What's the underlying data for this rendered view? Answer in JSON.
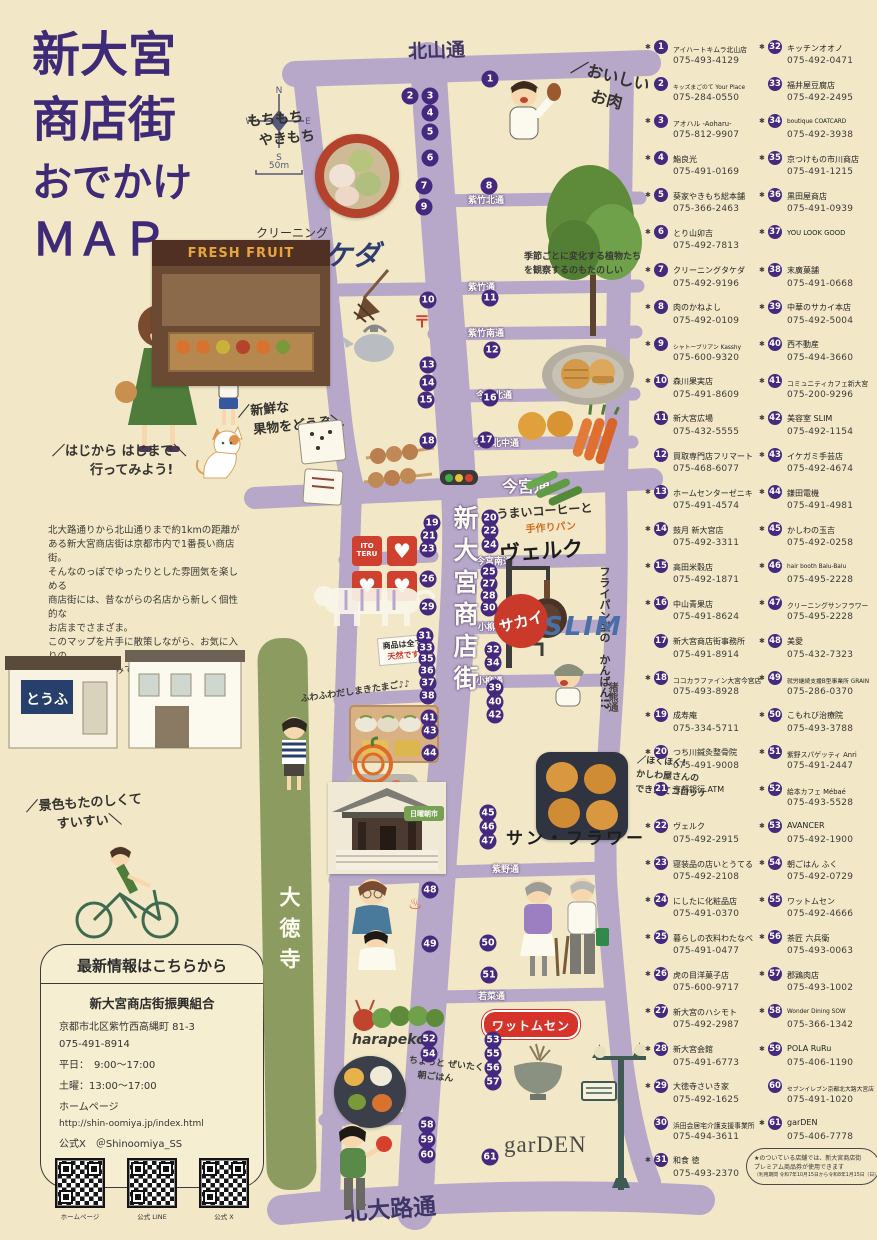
{
  "colors": {
    "bg": "#f2e8c7",
    "road": "#b7a8c9",
    "marker_purple": "#45297e",
    "title_purple": "#3e2a76",
    "red": "#cf3b2a",
    "green_strip": "#8c9c60",
    "street_dark": "#3f3566"
  },
  "title": {
    "lines": [
      "新大宮",
      "商店街",
      "おでかけ",
      "ＭＡＰ"
    ]
  },
  "intro": "北大路通りから北山通りまで約1kmの距離が\nある新大宮商店街は京都市内で1番長い商店街。\nそんなのっぽでゆったりとした雰囲気を楽しめる\n商店街には、昔ながらの名店から新しく個性的な\nお店までさまざま。\nこのマップを片手に散策しながら、お気に入りの\nお店を見つけてみてください♩",
  "compass": {
    "n": "N",
    "e": "E",
    "s": "S",
    "w": "W",
    "scale": "50m"
  },
  "streets": {
    "kitayama": "北山通",
    "shichiku_kita": "紫竹北通",
    "shichiku": "紫竹通",
    "shichiku_minami": "紫竹南通",
    "imamiya_kita": "今宮北通",
    "imamiya_kitanaka": "今宮北中通",
    "imamiya": "今宮通",
    "imamiya_minami": "今宮南通",
    "koyanagi_kita": "小柳北通",
    "koyanagi": "小柳通",
    "inokuma": "猪熊通",
    "murasakino": "紫野通",
    "wakana": "若菜通",
    "kitaoji": "北大路通",
    "daitokuji": "大徳寺",
    "shotengai": "新大宮商店街"
  },
  "callouts": {
    "mochi1": "もちもち",
    "mochi2": "やきもち",
    "takeda_small": "クリーニング",
    "takeda_big": "タケダ",
    "oniku1": "おいしい",
    "oniku2": "お肉",
    "seasonal": "季節ごとに変化する植物たちを観察するのもたのしい",
    "fresh1": "新鮮な",
    "fresh2": "果物をどうぞ",
    "walk1": "はじから はじまで",
    "walk2": "行ってみよう!",
    "verk1": "うまいコーヒーと",
    "verk2": "手作りパン",
    "verk_name": "ヴェルク",
    "frypan1": "フライパン型の",
    "frypan2": "かんばん!?",
    "tennen1": "商品は全て",
    "tennen2": "天然です",
    "dashimaki": "ふわふわだしまきたまご♪♪",
    "croq1": "ほくほく!",
    "croq2": "かしわ屋さんの",
    "croq3": "できたてコロッケ",
    "sunflower": "サン・フラワー",
    "scenery1": "景色もたのしくて",
    "scenery2": "すいすい",
    "breakfast1": "ちょっと ぜいたくな",
    "breakfast2": "朝ごはん",
    "harapeko": "harapeko",
    "wattomsen": "ワットムセン",
    "garden": "garDEN",
    "sakai": "サカイ",
    "slim": "SLIM",
    "itoteru": "ITO TERU",
    "freshfruit": "FRESH FRUIT",
    "tofu": "とうふ",
    "temple_badge": "日曜朝市",
    "post_mark": "〒",
    "onsen_mark": "♨"
  },
  "info_box": {
    "title": "最新情報はこちらから",
    "org": "新大宮商店街振興組合",
    "address": "京都市北区紫竹西高縄町 81-3",
    "phone": "075-491-8914",
    "weekday": "平日：　9:00～17:00",
    "saturday": "土曜：13:00～17:00",
    "hp_label": "ホームページ",
    "url": "http://shin-oomiya.jp/index.html",
    "official_x": "公式X　＠Shinoomiya_SS",
    "qr_labels": [
      "ホームページ",
      "公式 LINE",
      "公式 X"
    ]
  },
  "map": {
    "markers": [
      {
        "n": 1,
        "x": 490,
        "y": 79
      },
      {
        "n": 2,
        "x": 410,
        "y": 96
      },
      {
        "n": 3,
        "x": 430,
        "y": 96
      },
      {
        "n": 4,
        "x": 430,
        "y": 113
      },
      {
        "n": 5,
        "x": 430,
        "y": 132
      },
      {
        "n": 6,
        "x": 430,
        "y": 158
      },
      {
        "n": 7,
        "x": 424,
        "y": 186
      },
      {
        "n": 8,
        "x": 489,
        "y": 186
      },
      {
        "n": 9,
        "x": 424,
        "y": 207
      },
      {
        "n": 10,
        "x": 428,
        "y": 300
      },
      {
        "n": 11,
        "x": 490,
        "y": 298
      },
      {
        "n": 12,
        "x": 492,
        "y": 350
      },
      {
        "n": 13,
        "x": 428,
        "y": 365
      },
      {
        "n": 14,
        "x": 428,
        "y": 383
      },
      {
        "n": 15,
        "x": 426,
        "y": 400
      },
      {
        "n": 16,
        "x": 490,
        "y": 398
      },
      {
        "n": 17,
        "x": 486,
        "y": 440
      },
      {
        "n": 18,
        "x": 428,
        "y": 441
      },
      {
        "n": 19,
        "x": 432,
        "y": 523
      },
      {
        "n": 20,
        "x": 490,
        "y": 518
      },
      {
        "n": 21,
        "x": 429,
        "y": 536
      },
      {
        "n": 22,
        "x": 490,
        "y": 531
      },
      {
        "n": 23,
        "x": 428,
        "y": 549
      },
      {
        "n": 24,
        "x": 490,
        "y": 545
      },
      {
        "n": 25,
        "x": 489,
        "y": 572
      },
      {
        "n": 26,
        "x": 428,
        "y": 579
      },
      {
        "n": 27,
        "x": 489,
        "y": 584
      },
      {
        "n": 28,
        "x": 489,
        "y": 596
      },
      {
        "n": 29,
        "x": 428,
        "y": 607
      },
      {
        "n": 30,
        "x": 489,
        "y": 608
      },
      {
        "n": 31,
        "x": 425,
        "y": 636
      },
      {
        "n": 32,
        "x": 493,
        "y": 650
      },
      {
        "n": 33,
        "x": 426,
        "y": 648
      },
      {
        "n": 34,
        "x": 493,
        "y": 663
      },
      {
        "n": 35,
        "x": 427,
        "y": 659
      },
      {
        "n": 36,
        "x": 427,
        "y": 671
      },
      {
        "n": 37,
        "x": 428,
        "y": 683
      },
      {
        "n": 38,
        "x": 428,
        "y": 696
      },
      {
        "n": 39,
        "x": 495,
        "y": 688
      },
      {
        "n": 40,
        "x": 495,
        "y": 702
      },
      {
        "n": 41,
        "x": 429,
        "y": 718
      },
      {
        "n": 42,
        "x": 495,
        "y": 715
      },
      {
        "n": 43,
        "x": 430,
        "y": 731
      },
      {
        "n": 44,
        "x": 430,
        "y": 753
      },
      {
        "n": 45,
        "x": 488,
        "y": 813
      },
      {
        "n": 46,
        "x": 488,
        "y": 827
      },
      {
        "n": 47,
        "x": 488,
        "y": 841
      },
      {
        "n": 48,
        "x": 430,
        "y": 890
      },
      {
        "n": 49,
        "x": 430,
        "y": 944
      },
      {
        "n": 50,
        "x": 488,
        "y": 943
      },
      {
        "n": 51,
        "x": 489,
        "y": 975
      },
      {
        "n": 52,
        "x": 429,
        "y": 1039
      },
      {
        "n": 53,
        "x": 493,
        "y": 1040
      },
      {
        "n": 54,
        "x": 429,
        "y": 1054
      },
      {
        "n": 55,
        "x": 493,
        "y": 1054
      },
      {
        "n": 56,
        "x": 493,
        "y": 1068
      },
      {
        "n": 57,
        "x": 493,
        "y": 1082
      },
      {
        "n": 58,
        "x": 427,
        "y": 1125
      },
      {
        "n": 59,
        "x": 427,
        "y": 1140
      },
      {
        "n": 60,
        "x": 427,
        "y": 1155
      },
      {
        "n": 61,
        "x": 490,
        "y": 1157
      }
    ]
  },
  "directory": {
    "col1": [
      {
        "n": 1,
        "name": "アイハートキムラ北山店",
        "phone": "075-493-4129",
        "star": true
      },
      {
        "n": 2,
        "name": "キッズまごのて Your Place",
        "phone": "075-284-0550",
        "star": false
      },
      {
        "n": 3,
        "name": "アオハル -Aoharu-",
        "phone": "075-812-9907",
        "star": true
      },
      {
        "n": 4,
        "name": "鮨良光",
        "phone": "075-491-0169",
        "star": true
      },
      {
        "n": 5,
        "name": "葵家やきもち総本舗",
        "phone": "075-366-2463",
        "star": true
      },
      {
        "n": 6,
        "name": "とり山卯吉",
        "phone": "075-492-7813",
        "star": true
      },
      {
        "n": 7,
        "name": "クリーニングタケダ",
        "phone": "075-492-9196",
        "star": true
      },
      {
        "n": 8,
        "name": "肉のかねよし",
        "phone": "075-492-0109",
        "star": true
      },
      {
        "n": 9,
        "name": "シャトーブリアン Kasshy",
        "phone": "075-600-9320",
        "star": true
      },
      {
        "n": 10,
        "name": "森川果実店",
        "phone": "075-491-8609",
        "star": true
      },
      {
        "n": 11,
        "name": "新大宮広場",
        "phone": "075-432-5555",
        "star": false
      },
      {
        "n": 12,
        "name": "買取専門店フリマート",
        "phone": "075-468-6077",
        "star": false
      },
      {
        "n": 13,
        "name": "ホームセンターゼニキ",
        "phone": "075-491-4574",
        "star": true
      },
      {
        "n": 14,
        "name": "鼓月 新大宮店",
        "phone": "075-492-3311",
        "star": true
      },
      {
        "n": 15,
        "name": "高田米穀店",
        "phone": "075-492-1871",
        "star": true
      },
      {
        "n": 16,
        "name": "中山青果店",
        "phone": "075-491-8624",
        "star": true
      },
      {
        "n": 17,
        "name": "新大宮商店街事務所",
        "phone": "075-491-8914",
        "star": false
      },
      {
        "n": 18,
        "name": "ココカラファイン大宮今宮店",
        "phone": "075-493-8928",
        "star": true
      },
      {
        "n": 19,
        "name": "成寿庵",
        "phone": "075-334-5711",
        "star": true
      },
      {
        "n": 20,
        "name": "つち川鍼灸整骨院",
        "phone": "075-491-9008",
        "star": true
      },
      {
        "n": 21,
        "name": "京都銀行 ATM",
        "phone": "",
        "star": false
      },
      {
        "n": 22,
        "name": "ヴェルク",
        "phone": "075-492-2915",
        "star": true
      },
      {
        "n": 23,
        "name": "寝装品の店いとうてる",
        "phone": "075-492-2108",
        "star": true
      },
      {
        "n": 24,
        "name": "にしたに化粧品店",
        "phone": "075-491-0370",
        "star": true
      },
      {
        "n": 25,
        "name": "暮らしの衣料わたなべ",
        "phone": "075-491-0477",
        "star": true
      },
      {
        "n": 26,
        "name": "虎の目洋菓子店",
        "phone": "075-600-9717",
        "star": true
      },
      {
        "n": 27,
        "name": "新大宮のハシモト",
        "phone": "075-492-2987",
        "star": true
      },
      {
        "n": 28,
        "name": "新大宮会館",
        "phone": "075-491-6773",
        "star": true
      },
      {
        "n": 29,
        "name": "大徳寺さいき家",
        "phone": "075-492-1625",
        "star": true
      },
      {
        "n": 30,
        "name": "浜田会居宅介護支援事業所",
        "phone": "075-494-3611",
        "star": false
      },
      {
        "n": 31,
        "name": "和食 徳",
        "phone": "075-493-2370",
        "star": true
      }
    ],
    "col2": [
      {
        "n": 32,
        "name": "キッチンオオノ",
        "phone": "075-492-0471",
        "star": true
      },
      {
        "n": 33,
        "name": "福井屋豆腐店",
        "phone": "075-492-2495",
        "star": false
      },
      {
        "n": 34,
        "name": "boutique COATCARD",
        "phone": "075-492-3938",
        "star": true
      },
      {
        "n": 35,
        "name": "京つけもの市川商店",
        "phone": "075-491-1215",
        "star": true
      },
      {
        "n": 36,
        "name": "黒田屋商店",
        "phone": "075-491-0939",
        "star": true
      },
      {
        "n": 37,
        "name": "YOU LOOK GOOD",
        "phone": "",
        "star": true
      },
      {
        "n": 38,
        "name": "末廣菓舗",
        "phone": "075-491-0668",
        "star": true
      },
      {
        "n": 39,
        "name": "中華のサカイ本店",
        "phone": "075-492-5004",
        "star": true
      },
      {
        "n": 40,
        "name": "西不動産",
        "phone": "075-494-3660",
        "star": true
      },
      {
        "n": 41,
        "name": "コミュニティカフェ新大宮",
        "phone": "075-200-9296",
        "star": true
      },
      {
        "n": 42,
        "name": "美容室 SLIM",
        "phone": "075-492-1154",
        "star": true
      },
      {
        "n": 43,
        "name": "イケガミ手芸店",
        "phone": "075-492-4674",
        "star": true
      },
      {
        "n": 44,
        "name": "鎌田電機",
        "phone": "075-491-4981",
        "star": true
      },
      {
        "n": 45,
        "name": "かしわの玉吉",
        "phone": "075-492-0258",
        "star": true
      },
      {
        "n": 46,
        "name": "hair booth Balu-Balu",
        "phone": "075-495-2228",
        "star": true
      },
      {
        "n": 47,
        "name": "クリーニングサンフラワー",
        "phone": "075-495-2228",
        "star": true
      },
      {
        "n": 48,
        "name": "美愛",
        "phone": "075-432-7323",
        "star": true
      },
      {
        "n": 49,
        "name": "就労継続支援B型事業所 GRAIN",
        "phone": "075-286-0370",
        "star": true
      },
      {
        "n": 50,
        "name": "こもれび治療院",
        "phone": "075-493-3788",
        "star": true
      },
      {
        "n": 51,
        "name": "紫野スパゲッティ Anri",
        "phone": "075-491-2447",
        "star": true
      },
      {
        "n": 52,
        "name": "絵本カフェ Mébaé",
        "phone": "075-493-5528",
        "star": true
      },
      {
        "n": 53,
        "name": "AVANCER",
        "phone": "075-492-1900",
        "star": true
      },
      {
        "n": 54,
        "name": "朝ごはん ふく",
        "phone": "075-492-0729",
        "star": true
      },
      {
        "n": 55,
        "name": "ワットムセン",
        "phone": "075-492-4666",
        "star": true
      },
      {
        "n": 56,
        "name": "茶匠 六兵衛",
        "phone": "075-493-0063",
        "star": true
      },
      {
        "n": 57,
        "name": "郡鶏肉店",
        "phone": "075-493-1002",
        "star": true
      },
      {
        "n": 58,
        "name": "Wonder Dining SOW",
        "phone": "075-366-1342",
        "star": true
      },
      {
        "n": 59,
        "name": "POLA RuRu",
        "phone": "075-406-1190",
        "star": true
      },
      {
        "n": 60,
        "name": "セブンイレブン京都北大路大宮店",
        "phone": "075-491-1020",
        "star": false
      },
      {
        "n": 61,
        "name": "garDEN",
        "phone": "075-406-7778",
        "star": true
      }
    ],
    "note": [
      "★のついている店舗では、新大宮商店街",
      "プレミアム商品券が使用できます",
      "（利用期間 令和7年10月15日から令和8年1月15日（日））"
    ]
  }
}
